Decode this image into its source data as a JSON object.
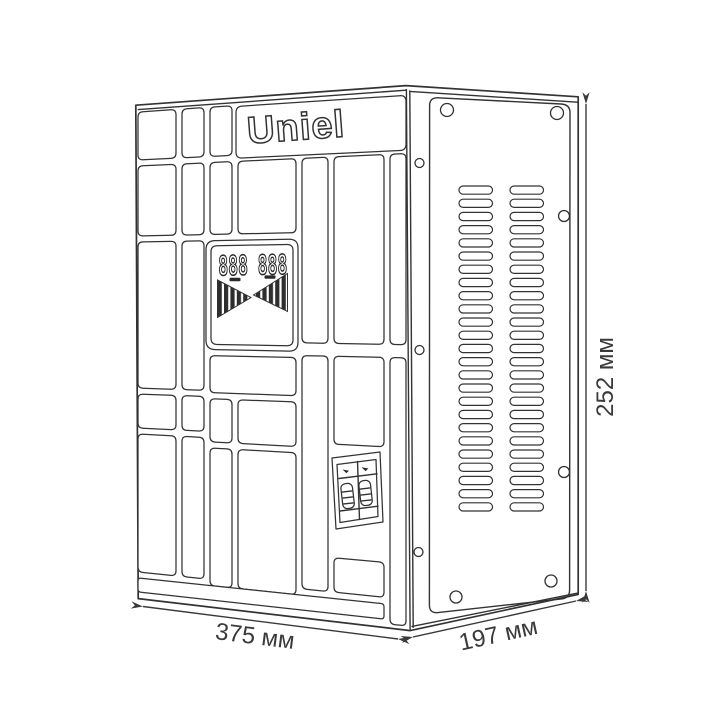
{
  "product": {
    "brand": "Uniel"
  },
  "display": {
    "digits": "888 888"
  },
  "dimensions": {
    "width": "375 мм",
    "depth": "197 мм",
    "height": "252 мм"
  },
  "colors": {
    "line": "#333333",
    "background": "#ffffff"
  }
}
